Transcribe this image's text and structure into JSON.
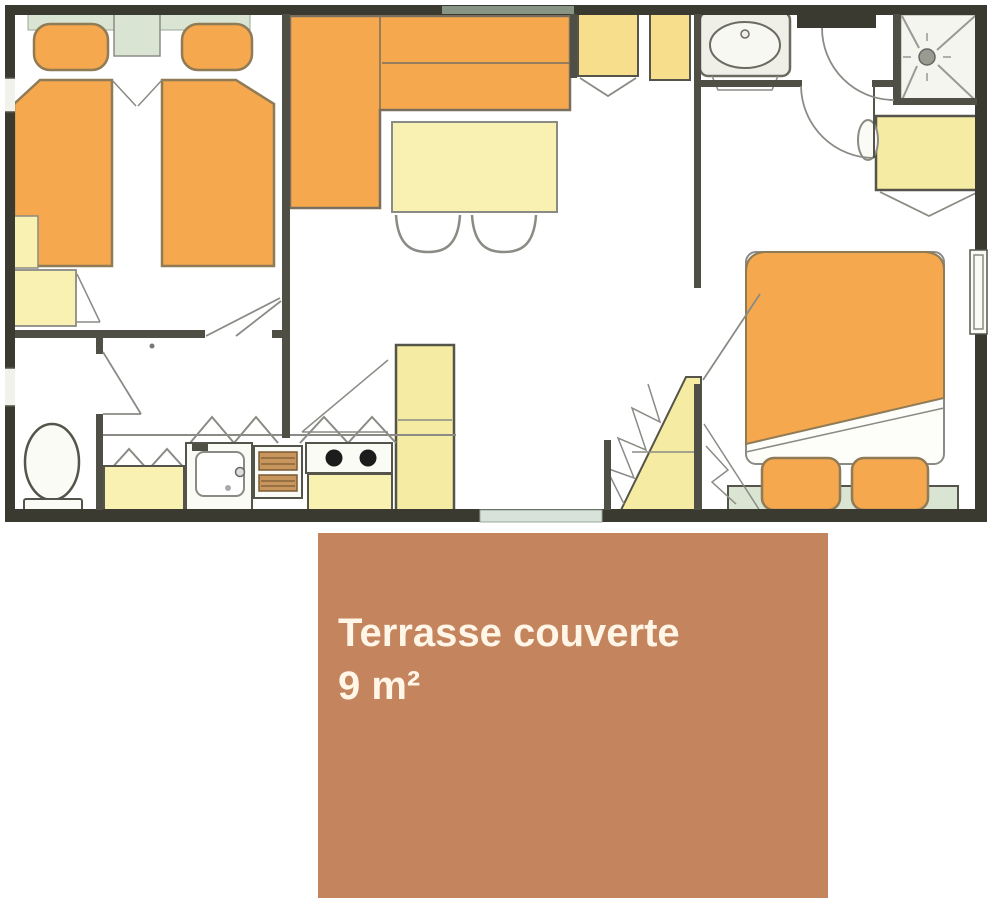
{
  "terrace_label": {
    "title": "Terrasse couverte",
    "area": "9 m²"
  },
  "colors": {
    "wall-dark": "#3B3A30",
    "wall-mid": "#504F46",
    "line-gray": "#8B8B85",
    "furniture-orange": "#F5A84E",
    "orange-border": "#8F7B56",
    "pale-yellow": "#F9F1B2",
    "mid-yellow": "#F5EBA2",
    "gold-yellow": "#F6DE8C",
    "green-tint": "#D9E5D2",
    "fixture-white": "#FBFBF6",
    "oven-brown": "#C8965C",
    "oven-dark": "#7A5A35",
    "burner-black": "#1C1C1C",
    "terrace-brown": "#C4845E",
    "terrace-text": "#FFF6E8",
    "entry-pale": "#D8E2DA"
  }
}
